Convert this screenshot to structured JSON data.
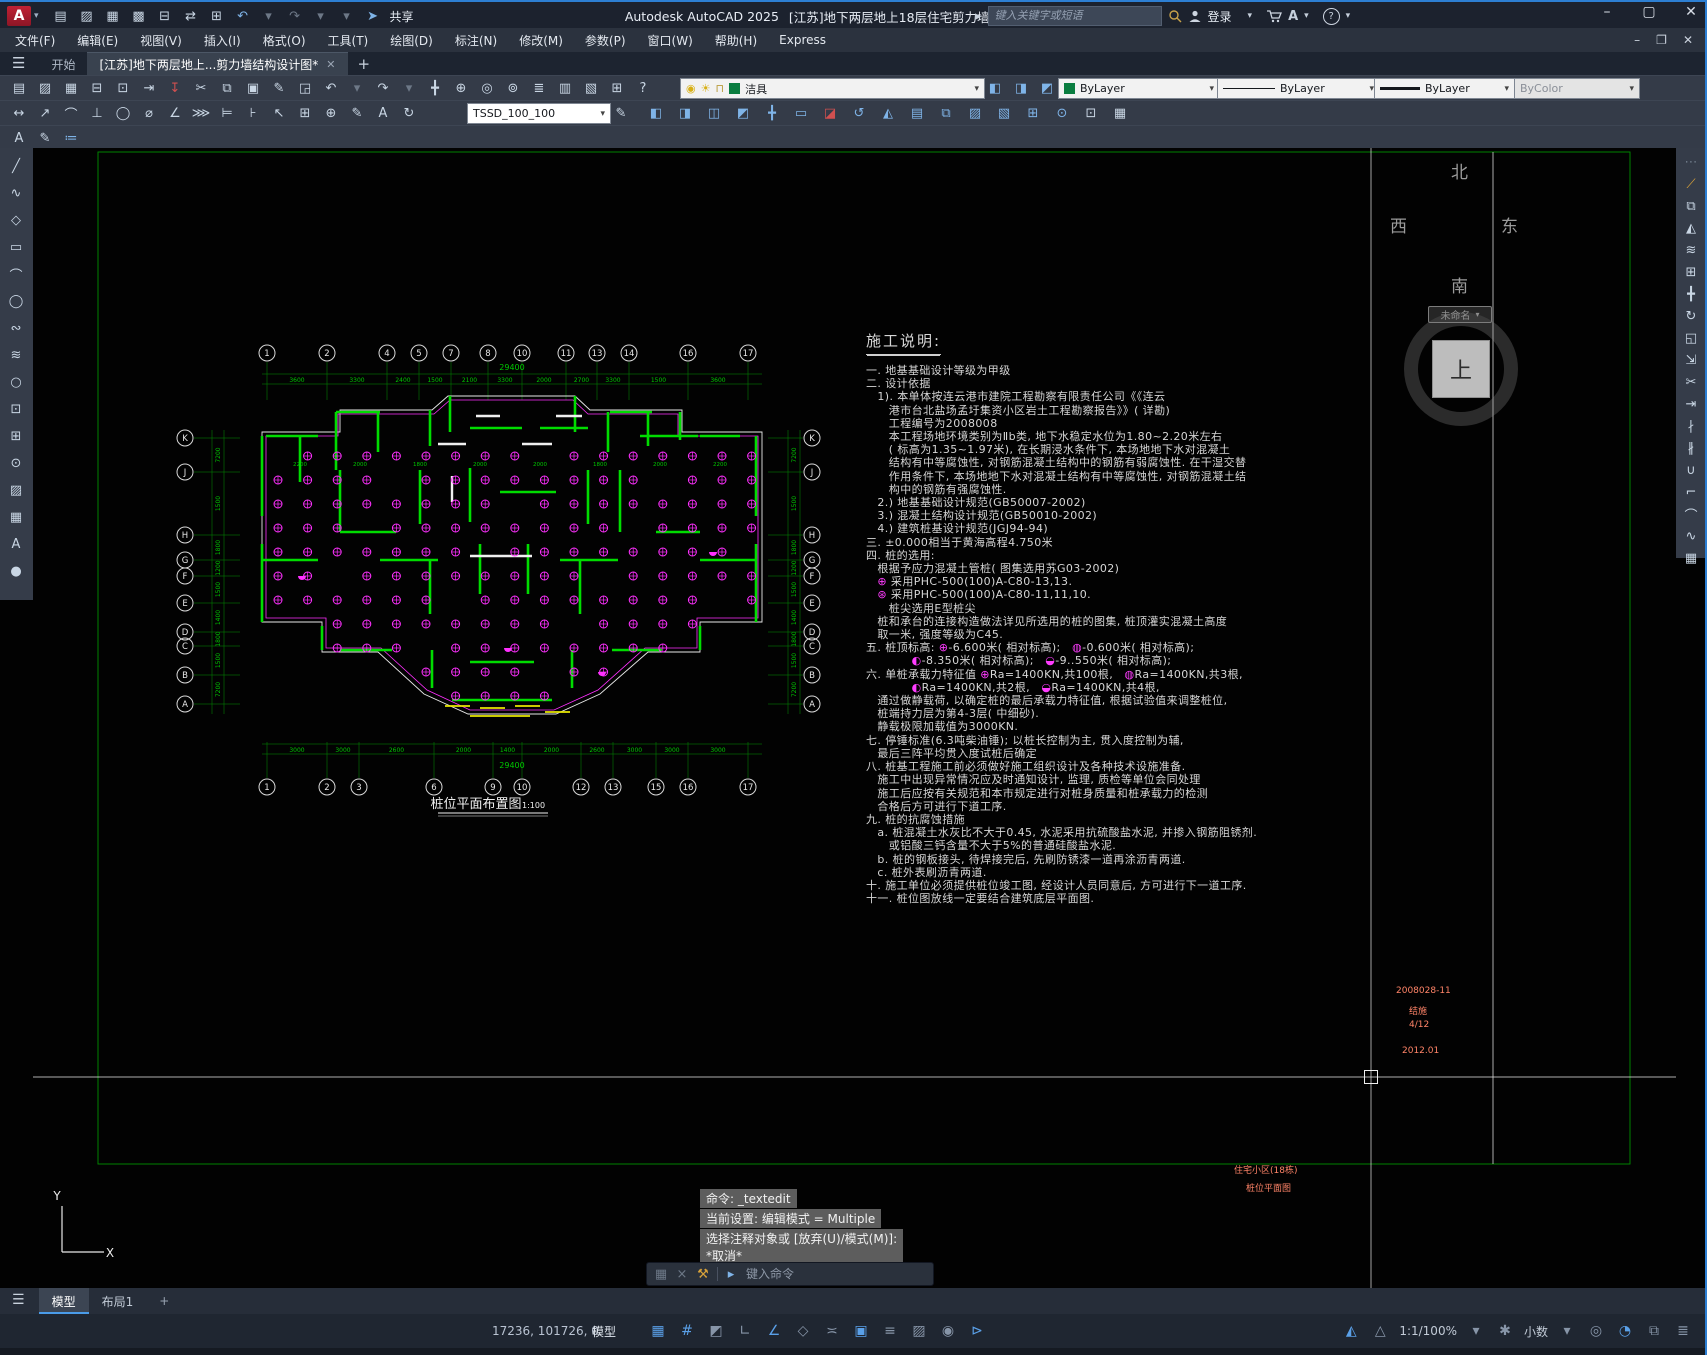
{
  "window": {
    "app_title": "Autodesk AutoCAD 2025",
    "doc_title": "[江苏]地下两层地上18层住宅剪力墙结构设计图.dwg",
    "share_label": "共享",
    "search_placeholder": "键入关键字或短语",
    "signin_label": "登录",
    "minimize": "–",
    "maximize": "▢",
    "close": "✕",
    "doc_minimize": "–",
    "doc_restore": "❐",
    "doc_close": "✕"
  },
  "menus": [
    "文件(F)",
    "编辑(E)",
    "视图(V)",
    "插入(I)",
    "格式(O)",
    "工具(T)",
    "绘图(D)",
    "标注(N)",
    "修改(M)",
    "参数(P)",
    "窗口(W)",
    "帮助(H)",
    "Express"
  ],
  "filetabs": {
    "start": "开始",
    "doc": "[江苏]地下两层地上...剪力墙结构设计图*",
    "close": "✕",
    "new_tab": "+"
  },
  "toolbar": {
    "layer_value": "洁具",
    "color_value": "ByLayer",
    "linetype_value": "ByLayer",
    "lineweight_value": "ByLayer",
    "plotstyle_value": "ByColor",
    "dimstyle_value": "TSSD_100_100"
  },
  "icons": {
    "qat": [
      {
        "n": "qnew",
        "g": "▤"
      },
      {
        "n": "open",
        "g": "▨"
      },
      {
        "n": "save",
        "g": "▦"
      },
      {
        "n": "save-as",
        "g": "▩"
      },
      {
        "n": "plot",
        "g": "⊟"
      },
      {
        "n": "transfer",
        "g": "⇄"
      },
      {
        "n": "print",
        "g": "⊞"
      },
      {
        "n": "undo",
        "g": "↶",
        "c": "blue"
      },
      {
        "n": "undo-dropdown",
        "g": "▾",
        "c": "gray"
      },
      {
        "n": "redo",
        "g": "↷",
        "c": "gray"
      },
      {
        "n": "redo-dropdown",
        "g": "▾",
        "c": "gray"
      },
      {
        "n": "qat-customize",
        "g": "▾",
        "c": "gray"
      },
      {
        "n": "share",
        "g": "➤",
        "c": "blue"
      }
    ],
    "row1": [
      {
        "n": "qnew",
        "g": "▤"
      },
      {
        "n": "open",
        "g": "▨"
      },
      {
        "n": "save",
        "g": "▦"
      },
      {
        "n": "plot",
        "g": "⊟"
      },
      {
        "n": "plot-preview",
        "g": "⊡"
      },
      {
        "n": "publish",
        "g": "⇥"
      },
      {
        "n": "export-dwf",
        "g": "↧",
        "c": "red"
      },
      {
        "n": "cut-clip",
        "g": "✂"
      },
      {
        "n": "copy-clip",
        "g": "⧉"
      },
      {
        "n": "paste-clip",
        "g": "▣"
      },
      {
        "n": "match-properties",
        "g": "✎"
      },
      {
        "n": "edit-references",
        "g": "◲"
      },
      {
        "n": "undo",
        "g": "↶"
      },
      {
        "n": "undo-dropdown",
        "g": "▾",
        "c": "gray"
      },
      {
        "n": "redo",
        "g": "↷"
      },
      {
        "n": "redo-dropdown",
        "g": "▾",
        "c": "gray"
      },
      {
        "n": "pan-realtime",
        "g": "╋"
      },
      {
        "n": "zoom-realtime",
        "g": "⊕"
      },
      {
        "n": "zoom-window",
        "g": "◎"
      },
      {
        "n": "zoom-previous",
        "g": "⊚"
      },
      {
        "n": "layer-properties",
        "g": "≣"
      },
      {
        "n": "layer-states",
        "g": "▥"
      },
      {
        "n": "properties-palette",
        "g": "▧"
      },
      {
        "n": "quickcalc",
        "g": "⊞"
      },
      {
        "n": "help",
        "g": "?"
      }
    ],
    "row1b": [
      {
        "n": "layer-isolate",
        "g": "◧",
        "c": "blue"
      },
      {
        "n": "layer-unisolate",
        "g": "◨",
        "c": "blue"
      },
      {
        "n": "layer-previous",
        "g": "◩",
        "c": "blue"
      }
    ],
    "row2": [
      {
        "n": "dim-linear",
        "g": "↔"
      },
      {
        "n": "dim-aligned",
        "g": "↗"
      },
      {
        "n": "dim-arc",
        "g": "⌒"
      },
      {
        "n": "dim-ordinate",
        "g": "⊥"
      },
      {
        "n": "dim-radius",
        "g": "◯"
      },
      {
        "n": "dim-diameter",
        "g": "⌀"
      },
      {
        "n": "dim-angular",
        "g": "∠"
      },
      {
        "n": "dim-quick",
        "g": "⋙"
      },
      {
        "n": "dim-baseline",
        "g": "⊨"
      },
      {
        "n": "dim-continue",
        "g": "⊦"
      },
      {
        "n": "dim-leader",
        "g": "↖"
      },
      {
        "n": "dim-tolerance",
        "g": "⊞"
      },
      {
        "n": "dim-center-mark",
        "g": "⊕"
      },
      {
        "n": "dim-edit",
        "g": "✎"
      },
      {
        "n": "dim-text-edit",
        "g": "A"
      },
      {
        "n": "dim-update",
        "g": "↻"
      }
    ],
    "tssd": [
      {
        "n": "tssd-wall",
        "g": "◧",
        "c": "blue"
      },
      {
        "n": "tssd-column",
        "g": "◨",
        "c": "blue"
      },
      {
        "n": "tssd-beam",
        "g": "◫",
        "c": "blue"
      },
      {
        "n": "tssd-slab",
        "g": "◩",
        "c": "blue"
      },
      {
        "n": "tssd-move",
        "g": "╋",
        "c": "blue"
      },
      {
        "n": "tssd-door",
        "g": "▭",
        "c": "blue"
      },
      {
        "n": "tssd-erase",
        "g": "◪",
        "c": "red"
      },
      {
        "n": "tssd-rotate",
        "g": "↺",
        "c": "blue"
      },
      {
        "n": "tssd-mirror",
        "g": "◭",
        "c": "blue"
      },
      {
        "n": "tssd-stair",
        "g": "▤",
        "c": "blue"
      },
      {
        "n": "tssd-copy",
        "g": "⧉",
        "c": "blue"
      },
      {
        "n": "tssd-fill",
        "g": "▨",
        "c": "blue"
      },
      {
        "n": "tssd-hatch",
        "g": "▧",
        "c": "blue"
      },
      {
        "n": "tssd-grid",
        "g": "⊞",
        "c": "blue"
      },
      {
        "n": "tssd-pile",
        "g": "⊙",
        "c": "blue"
      },
      {
        "n": "tssd-insert",
        "g": "⊡",
        "c": "green"
      },
      {
        "n": "tssd-check",
        "g": "▦",
        "c": "green"
      }
    ],
    "row3": [
      {
        "n": "text-style",
        "g": "A"
      },
      {
        "n": "text-edit",
        "g": "✎"
      },
      {
        "n": "text-check",
        "g": "≔",
        "c": "blue"
      }
    ],
    "left": [
      {
        "n": "line",
        "g": "╱"
      },
      {
        "n": "polyline",
        "g": "∿"
      },
      {
        "n": "polygon",
        "g": "◇"
      },
      {
        "n": "rectangle",
        "g": "▭"
      },
      {
        "n": "arc",
        "g": "⌒"
      },
      {
        "n": "circle",
        "g": "◯"
      },
      {
        "n": "revision-cloud",
        "g": "∾"
      },
      {
        "n": "spline",
        "g": "≋"
      },
      {
        "n": "ellipse",
        "g": "○"
      },
      {
        "n": "insert-block",
        "g": "⊡"
      },
      {
        "n": "make-block",
        "g": "⊞"
      },
      {
        "n": "point",
        "g": "⊙"
      },
      {
        "n": "hatch",
        "g": "▨"
      },
      {
        "n": "table",
        "g": "▦"
      },
      {
        "n": "text",
        "g": "A"
      },
      {
        "n": "region",
        "g": "●"
      }
    ],
    "right": [
      {
        "n": "toolbar-handle",
        "g": "⋯",
        "c": "gray"
      },
      {
        "n": "erase",
        "g": "⟋",
        "c": "gold"
      },
      {
        "n": "copy",
        "g": "⧉"
      },
      {
        "n": "mirror",
        "g": "◭"
      },
      {
        "n": "offset",
        "g": "≋"
      },
      {
        "n": "array",
        "g": "⊞"
      },
      {
        "n": "move",
        "g": "╋"
      },
      {
        "n": "rotate",
        "g": "↻"
      },
      {
        "n": "scale",
        "g": "◱"
      },
      {
        "n": "stretch",
        "g": "⇲"
      },
      {
        "n": "trim",
        "g": "✂"
      },
      {
        "n": "extend",
        "g": "⇥"
      },
      {
        "n": "break-at-point",
        "g": "∤"
      },
      {
        "n": "break",
        "g": "∦"
      },
      {
        "n": "join",
        "g": "∪"
      },
      {
        "n": "chamfer",
        "g": "⌐"
      },
      {
        "n": "fillet",
        "g": "⌒"
      },
      {
        "n": "blend-curves",
        "g": "∿"
      },
      {
        "n": "explode",
        "g": "▦"
      }
    ],
    "sb_left": [
      {
        "n": "grid-display",
        "g": "▦",
        "on": true
      },
      {
        "n": "snap-mode",
        "g": "#",
        "on": true
      },
      {
        "n": "infer-constraints",
        "g": "◩"
      },
      {
        "n": "ortho-mode",
        "g": "∟"
      },
      {
        "n": "polar-tracking",
        "g": "∠",
        "on": true
      },
      {
        "n": "isometric-drafting",
        "g": "◇"
      },
      {
        "n": "object-snap-tracking",
        "g": "≍"
      },
      {
        "n": "object-snap",
        "g": "▣",
        "on": true
      },
      {
        "n": "lineweight-display",
        "g": "≡"
      },
      {
        "n": "transparency",
        "g": "▨"
      },
      {
        "n": "selection-cycling",
        "g": "◉"
      },
      {
        "n": "dynamic-input",
        "g": "⊳",
        "on": true
      }
    ],
    "sb_right": [
      {
        "n": "annotation-visibility",
        "g": "◭",
        "on": true
      },
      {
        "n": "autoscale",
        "g": "△"
      },
      {
        "n": "annotation-scale",
        "t": "1:1/100%"
      },
      {
        "n": "scale-dropdown",
        "g": "▾"
      },
      {
        "n": "workspace-switching",
        "g": "✱"
      },
      {
        "n": "units",
        "t": "小数"
      },
      {
        "n": "units-dropdown",
        "g": "▾"
      },
      {
        "n": "object-isolate",
        "g": "◎"
      },
      {
        "n": "graphics-performance",
        "g": "◔",
        "on": true
      },
      {
        "n": "clean-screen",
        "g": "⧉"
      },
      {
        "n": "customization",
        "g": "≣"
      }
    ]
  },
  "viewcube": {
    "north": "北",
    "south": "南",
    "west": "西",
    "east": "东",
    "top": "上",
    "named_view": "未命名",
    "pill_caret": "▾"
  },
  "notes": {
    "title": "施工说明:",
    "lines": [
      [
        [
          "t",
          "一. 地基基础设计等级为甲级"
        ]
      ],
      [
        [
          "t",
          "二. 设计依据"
        ]
      ],
      [
        [
          "t",
          "　1). 本单体按连云港市建院工程勘察有限责任公司《《连云"
        ]
      ],
      [
        [
          "t",
          "　　港市台北盐场孟圩集资小区岩土工程勘察报告》》( 详勘)"
        ]
      ],
      [
        [
          "t",
          "　　工程编号为2008008"
        ]
      ],
      [
        [
          "t",
          "　　本工程场地环境类别为Ⅱb类, 地下水稳定水位为1.80~2.20米左右"
        ]
      ],
      [
        [
          "t",
          "　　( 标高为1.35~1.97米), 在长期浸水条件下, 本场地地下水对混凝土"
        ]
      ],
      [
        [
          "t",
          "　　结构有中等腐蚀性, 对钢筋混凝土结构中的钢筋有弱腐蚀性. 在干湿交替"
        ]
      ],
      [
        [
          "t",
          "　　作用条件下, 本场地地下水对混凝土结构有中等腐蚀性, 对钢筋混凝土结"
        ]
      ],
      [
        [
          "t",
          "　　构中的钢筋有强腐蚀性."
        ]
      ],
      [
        [
          "t",
          "　2.) 地基基础设计规范(GB50007-2002)"
        ]
      ],
      [
        [
          "t",
          "　3.) 混凝土结构设计规范(GB50010-2002)"
        ]
      ],
      [
        [
          "t",
          "　4.) 建筑桩基设计规范(JGJ94-94)"
        ]
      ],
      [
        [
          "t",
          "三. ±0.000相当于黄海高程4.750米"
        ]
      ],
      [
        [
          "t",
          "四. 桩的选用:"
        ]
      ],
      [
        [
          "t",
          "　根据予应力混凝土管桩( 图集选用苏G03-2002)"
        ]
      ],
      [
        [
          "t",
          "　"
        ],
        [
          "p1",
          "⊕"
        ],
        [
          "t",
          " 采用PHC-500(100)A-C80-13,13."
        ]
      ],
      [
        [
          "t",
          "　"
        ],
        [
          "p2",
          "⊛"
        ],
        [
          "t",
          " 采用PHC-500(100)A-C80-11,11,10."
        ]
      ],
      [
        [
          "t",
          "　　桩尖选用E型桩尖"
        ]
      ],
      [
        [
          "t",
          "　桩和承台的连接构造做法详见所选用的桩的图集, 桩顶灌实混凝土高度"
        ]
      ],
      [
        [
          "t",
          "　取一米, 强度等级为C45."
        ]
      ],
      [
        [
          "t",
          "五. 桩顶标高: "
        ],
        [
          "p1",
          "⊕"
        ],
        [
          "t",
          "-6.600米( 相对标高);　"
        ],
        [
          "p3",
          "◍"
        ],
        [
          "t",
          "-0.600米( 相对标高);"
        ]
      ],
      [
        [
          "t",
          "　　　　"
        ],
        [
          "p3",
          "◐"
        ],
        [
          "t",
          "-8.350米( 相对标高);　"
        ],
        [
          "p4",
          "◒"
        ],
        [
          "t",
          "-9..550米( 相对标高);"
        ]
      ],
      [
        [
          "t",
          "六. 单桩承载力特征值 "
        ],
        [
          "p1",
          "⊕"
        ],
        [
          "t",
          "Ra=1400KN,共100根,　"
        ],
        [
          "p3",
          "◍"
        ],
        [
          "t",
          "Ra=1400KN,共3根,"
        ]
      ],
      [
        [
          "t",
          "　　　　"
        ],
        [
          "p3",
          "◐"
        ],
        [
          "t",
          "Ra=1400KN,共2根,　"
        ],
        [
          "p4",
          "◒"
        ],
        [
          "t",
          "Ra=1400KN,共4根,"
        ]
      ],
      [
        [
          "t",
          "　通过做静载荷, 以确定桩的最后承载力特征值, 根据试验值来调整桩位,"
        ]
      ],
      [
        [
          "t",
          "　桩端持力层为第4-3层( 中细砂)."
        ]
      ],
      [
        [
          "t",
          "　静载极限加载值为3000KN."
        ]
      ],
      [
        [
          "t",
          "七. 停锤标准(6.3吨柴油锤); 以桩长控制为主, 贯入度控制为辅,"
        ]
      ],
      [
        [
          "t",
          "　最后三阵平均贯入度试桩后确定"
        ]
      ],
      [
        [
          "t",
          "八. 桩基工程施工前必须做好施工组织设计及各种技术设施准备."
        ]
      ],
      [
        [
          "t",
          "　施工中出现异常情况应及时通知设计, 监理, 质检等单位会同处理"
        ]
      ],
      [
        [
          "t",
          "　施工后应按有关规范和本市规定进行对桩身质量和桩承载力的检测"
        ]
      ],
      [
        [
          "t",
          "　合格后方可进行下道工序."
        ]
      ],
      [
        [
          "t",
          "九. 桩的抗腐蚀措施"
        ]
      ],
      [
        [
          "t",
          "　a. 桩混凝土水灰比不大于0.45, 水泥采用抗硫酸盐水泥, 并掺入钢筋阻锈剂."
        ]
      ],
      [
        [
          "t",
          "　　或铝酸三钙含量不大于5%的普通硅酸盐水泥."
        ]
      ],
      [
        [
          "t",
          "　b. 桩的钢板接头, 待焊接完后, 先刷防锈漆一道再涂沥青两道."
        ]
      ],
      [
        [
          "t",
          "　c. 桩外表刷沥青两道."
        ]
      ],
      [
        [
          "t",
          "十. 施工单位必须提供桩位竣工图, 经设计人员同意后, 方可进行下一道工序."
        ]
      ],
      [
        [
          "t",
          "十一. 桩位图放线一定要结合建筑底层平面图."
        ]
      ]
    ]
  },
  "plan": {
    "title": "桩位平面布置图",
    "scale": "1:100",
    "total_dim": "29400",
    "top_axis_labels": [
      "1",
      "2",
      "4",
      "5",
      "7",
      "8",
      "10",
      "11",
      "13",
      "14",
      "16",
      "17"
    ],
    "bottom_axis_labels": [
      "1",
      "2",
      "3",
      "6",
      "9",
      "10",
      "12",
      "13",
      "15",
      "16",
      "17"
    ],
    "side_axis_labels": [
      "K",
      "J",
      "H",
      "G",
      "F",
      "E",
      "D",
      "C",
      "B",
      "A"
    ],
    "top_dims": [
      "3600",
      "3300",
      "2400",
      "1500",
      "2100",
      "3300",
      "2000",
      "2700",
      "3300",
      "1500",
      "3600"
    ],
    "bottom_dims": [
      "3000",
      "3000",
      "2600",
      "2000",
      "1400",
      "2000",
      "2600",
      "3000",
      "3000",
      "3000"
    ],
    "side_dims": [
      "7200",
      "1500",
      "1800",
      "1200",
      "1500",
      "1400",
      "1800",
      "1500",
      "7200"
    ],
    "inner_dims": [
      "2200",
      "2000",
      "1800",
      "2000",
      "2000",
      "1800",
      "2000",
      "2200"
    ]
  },
  "titleblock": {
    "project_no": "2008028-11",
    "category": "结施",
    "sheet_no": "4/12",
    "date": "2012.01",
    "project_name": "住宅小区(18栋)",
    "drawing_name": "桩位平面图"
  },
  "command": {
    "lines": [
      "命令: _textedit",
      "当前设置: 编辑模式 = Multiple",
      "选择注释对象或 [放弃(U)/模式(M)]:",
      "*取消*"
    ],
    "input_placeholder": "键入命令"
  },
  "ucs": {
    "x_label": "X",
    "y_label": "Y"
  },
  "layouttabs": {
    "model": "模型",
    "layout1": "布局1",
    "add": "+"
  },
  "statusbar": {
    "coords": "17236, 101726, 0",
    "model_label": "模型"
  },
  "colors": {
    "cad_green": "#00c800",
    "cad_magenta": "#ff30ff",
    "cad_white": "#e8e8e8",
    "cad_yellow": "#e8e800",
    "accent_blue": "#2d7fd3",
    "orange_text": "#ff8468"
  }
}
